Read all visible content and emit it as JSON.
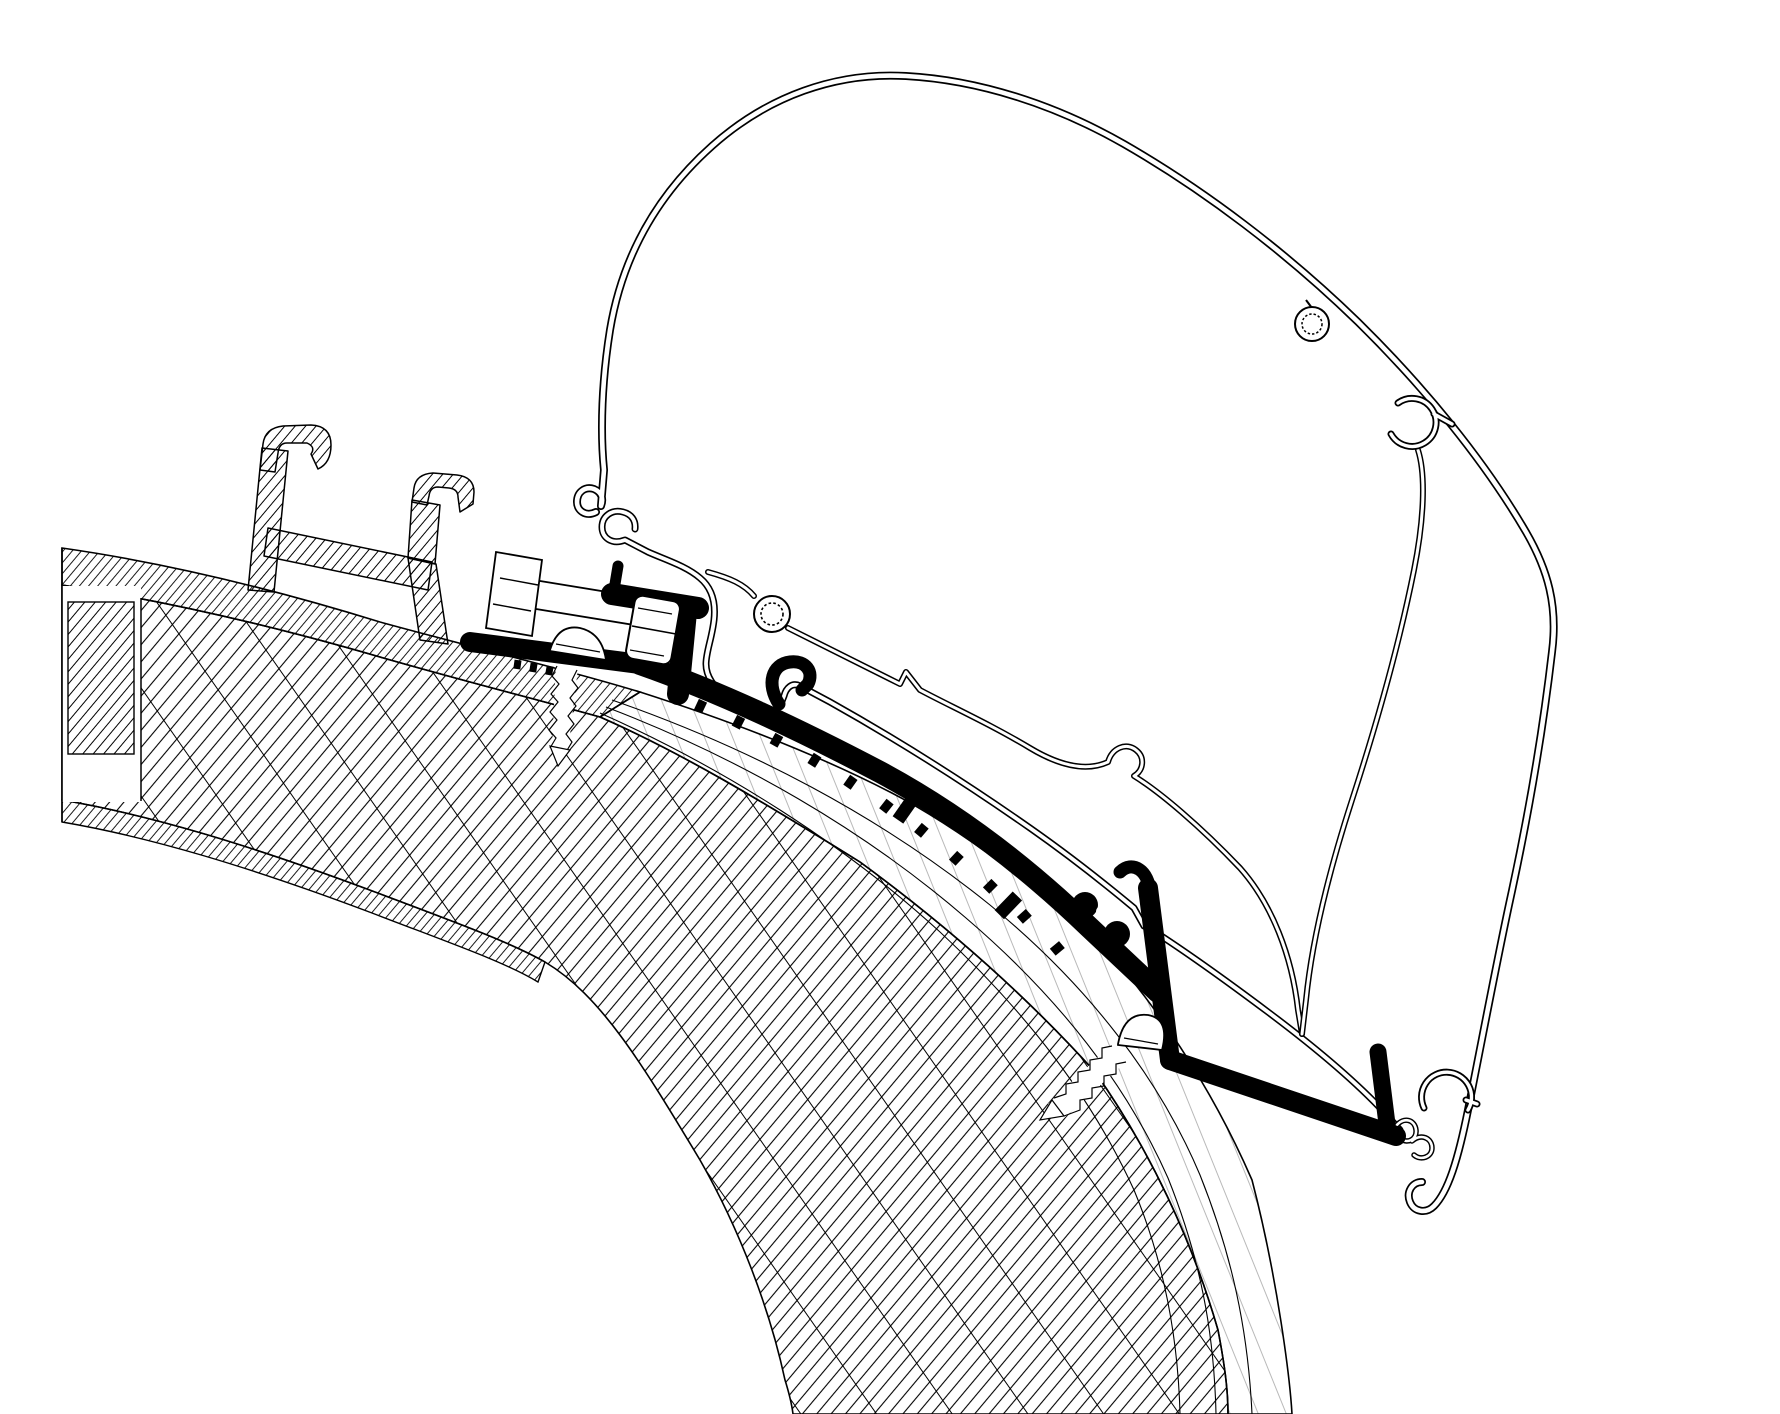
{
  "diagram": {
    "kind": "technical-cross-section-drawing",
    "description_names": [
      "vehicle-roof-sandwich-panel",
      "roof-top-skin",
      "roof-core-insulation",
      "roof-curved-laminate-layer",
      "roof-inner-skin",
      "existing-roof-rail-profile",
      "awning-adapter-profile",
      "hex-bolt",
      "clamp-nut",
      "pan-head-screw-front",
      "pan-head-screw-rear",
      "awning-cassette-shell",
      "cassette-mounting-wall",
      "cassette-screw-boss",
      "cassette-screw-channel-clip",
      "cassette-roller-catch-hook",
      "cassette-bottom-end-hooks",
      "fabric-exit-curl"
    ],
    "colors": {
      "background": "#ffffff",
      "line": "#000000",
      "adapter_fill": "#000000",
      "profile_fill": "#ffffff"
    }
  }
}
